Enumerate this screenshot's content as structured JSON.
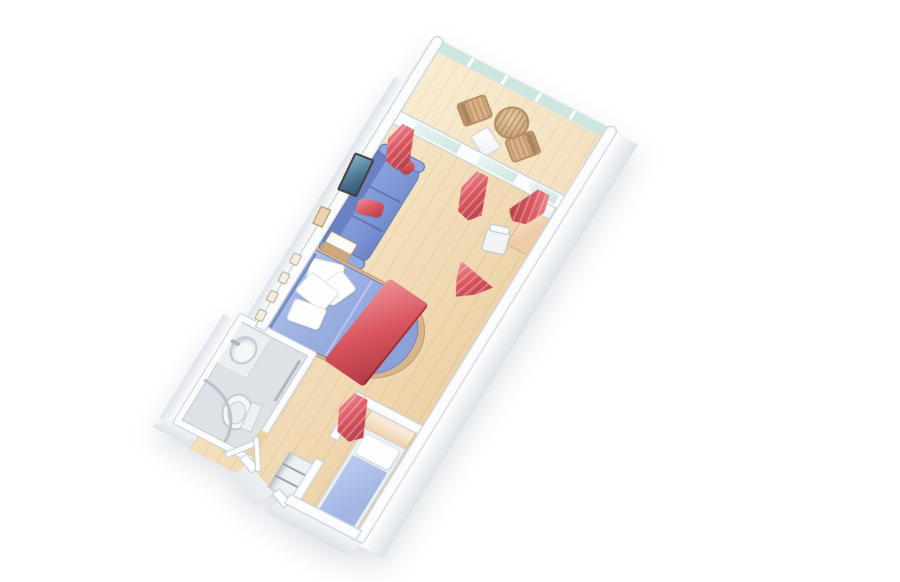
{
  "scene": {
    "type": "isometric-floor-plan",
    "subject": "balcony-stateroom",
    "rooms": [
      {
        "id": "balcony",
        "items": [
          "glass-railing",
          "round-wicker-table",
          "deck-chair-left",
          "deck-chair-right",
          "balcony-side-table",
          "privacy-divider"
        ]
      },
      {
        "id": "living-area",
        "items": [
          "sofa",
          "red-sofa-pillows",
          "wall-tv",
          "wall-art",
          "nightstand",
          "vanity-desk",
          "desk-chair",
          "sliding-glass-door",
          "window",
          "red-curtains",
          "room-divider-curtain"
        ]
      },
      {
        "id": "master-bedroom",
        "items": [
          "double-bed",
          "white-pillows",
          "red-bed-runner",
          "headboard",
          "reading-lamps",
          "wood-bed-rim"
        ]
      },
      {
        "id": "bathroom",
        "items": [
          "washbasin",
          "faucet",
          "counter",
          "toilet",
          "shower-enclosure",
          "towel-bar",
          "bathroom-door"
        ]
      },
      {
        "id": "second-bedroom",
        "items": [
          "single-bed",
          "single-bed-pillow",
          "wood-headboard",
          "privacy-curtain",
          "partition-wall"
        ]
      },
      {
        "id": "entry-hall",
        "items": [
          "entry-door",
          "shelf-unit",
          "landing"
        ]
      }
    ]
  },
  "palette": {
    "background": "#ffffff",
    "floor_wood": "#eccfa4",
    "floor_wood_light": "#f6e6c6",
    "balcony_floor": "#f3e0bf",
    "wall_white": "#fbfcfd",
    "wall_face": "#dde3ea",
    "wall_edge": "#c7cfd8",
    "glass_teal": "#cde7e0",
    "glass_frame": "#f0f5f4",
    "sofa_blue": "#7b93d2",
    "sofa_blue_dark": "#6a82c4",
    "sofa_blue_light": "#93a8e0",
    "bed_blue": "#8ba1da",
    "bed_blue_light": "#aabde8",
    "accent_red": "#d9545e",
    "accent_red_dark": "#b03a46",
    "accent_red_light": "#ef8f97",
    "pillow_white": "#fdfdfd",
    "wood_tan": "#d8b288",
    "wood_dark": "#b58c60",
    "wicker_light": "#e8cda6",
    "vanity_peach": "#f0cba8",
    "vanity_cream": "#fdf3e6",
    "bathroom_floor": "#dde2e7",
    "fixture_white": "#f5f7f8",
    "fixture_line": "#c3cbd2",
    "chrome": "#aeb7bf",
    "tv_frame": "#473e37",
    "tv_screen": "#4a7290",
    "headboard_blue": "#8096cd",
    "headboard_wood": "#ecd2ae",
    "single_bed_blue": "#a3b7e4",
    "single_bed_blue_light": "#bccbee",
    "wood_rim": "#d9b58c",
    "landing_gray": "#e4e9ee"
  }
}
